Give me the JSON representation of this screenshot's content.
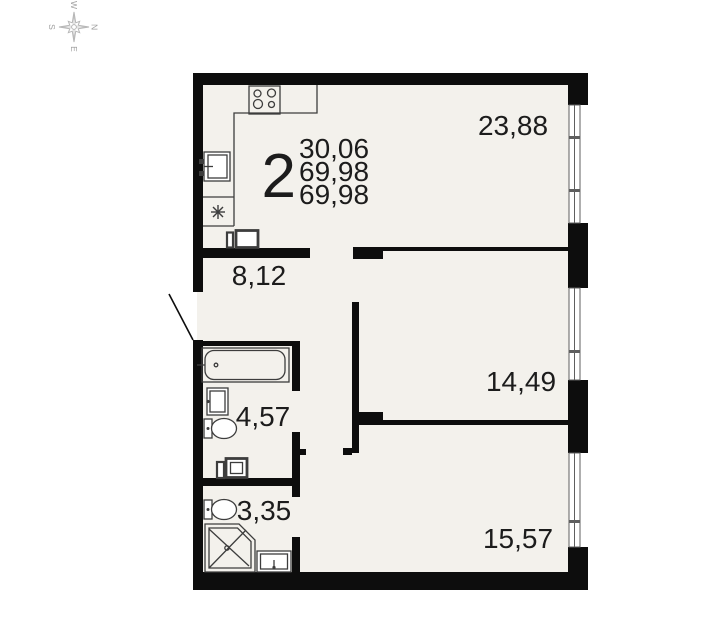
{
  "compass": {
    "north": "N",
    "east": "E",
    "south": "S",
    "west": "W"
  },
  "summary": {
    "room_count": "2",
    "living_area": "30,06",
    "total_area": "69,98",
    "total_area_2": "69,98"
  },
  "rooms": {
    "living_kitchen": {
      "area": "23,88"
    },
    "hallway": {
      "area": "8,12"
    },
    "bathroom": {
      "area": "4,57"
    },
    "bedroom_1": {
      "area": "14,49"
    },
    "shower_room": {
      "area": "3,35"
    },
    "bedroom_2": {
      "area": "15,57"
    }
  },
  "icons": {
    "fridge": "asterisk-snowflake",
    "compass": "compass-rose"
  },
  "colors": {
    "wall": "#0d0d0d",
    "floor": "#f3f1ec",
    "fixture": "#3d3d3d",
    "window": "#5f5f5f",
    "text": "#1c1c1c",
    "compass": "#b6b6b6",
    "page": "#ffffff"
  }
}
